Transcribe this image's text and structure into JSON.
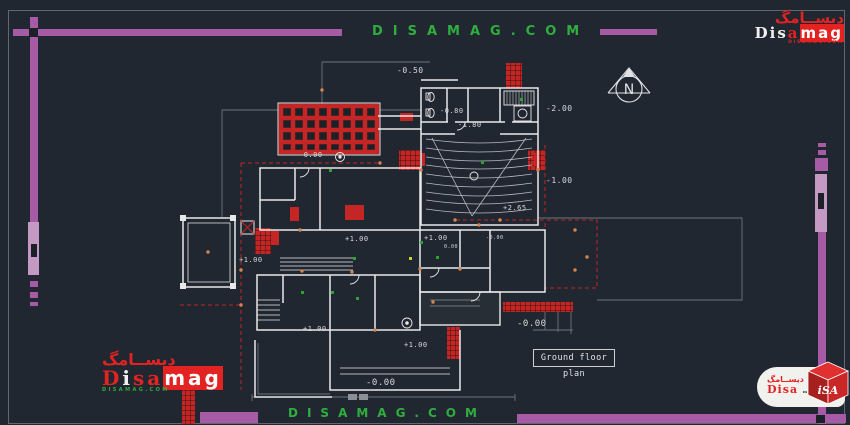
{
  "colors": {
    "background": "#212731",
    "magenta": "#a75ba7",
    "magenta_light": "#c49ac4",
    "watermark_green": "#2fae3e",
    "cad_red": "#c42525",
    "wall_white": "#e9e9e9",
    "gray_line": "#6d747b"
  },
  "watermark": {
    "top": "DISAMAG.COM",
    "bottom": "DISAMAG.COM"
  },
  "brand": {
    "persian": "دیســامگ",
    "latin_d": "D",
    "latin_i": "i",
    "latin_s": "s",
    "latin_a": "a",
    "suffix": "mag",
    "domain": "DISAMAG.COM",
    "cube_text": "iSA"
  },
  "plan": {
    "title": "Ground floor plan",
    "north_letter": "N",
    "levels": [
      {
        "t": "-0.50",
        "x": 397,
        "y": 67,
        "s": 8
      },
      {
        "t": "-0.80",
        "x": 440,
        "y": 108,
        "s": 7
      },
      {
        "t": "-1.80",
        "x": 458,
        "y": 122,
        "s": 7
      },
      {
        "t": "-2.00",
        "x": 546,
        "y": 105,
        "s": 8
      },
      {
        "t": "-1.00",
        "x": 546,
        "y": 177,
        "s": 8
      },
      {
        "t": "+2.65",
        "x": 503,
        "y": 205,
        "s": 7
      },
      {
        "t": "+1.00",
        "x": 424,
        "y": 235,
        "s": 7
      },
      {
        "t": "+1.00",
        "x": 345,
        "y": 236,
        "s": 7
      },
      {
        "t": "-0.00",
        "x": 486,
        "y": 236,
        "s": 5
      },
      {
        "t": "0.00",
        "x": 444,
        "y": 245,
        "s": 5
      },
      {
        "t": "+1.00",
        "x": 239,
        "y": 257,
        "s": 7
      },
      {
        "t": "+1.00",
        "x": 303,
        "y": 326,
        "s": 7
      },
      {
        "t": "+1.00",
        "x": 404,
        "y": 342,
        "s": 7
      },
      {
        "t": "-0.00",
        "x": 299,
        "y": 152,
        "s": 7
      },
      {
        "t": "-0.00",
        "x": 517,
        "y": 320,
        "s": 9
      },
      {
        "t": "-0.00",
        "x": 366,
        "y": 379,
        "s": 9
      }
    ]
  }
}
